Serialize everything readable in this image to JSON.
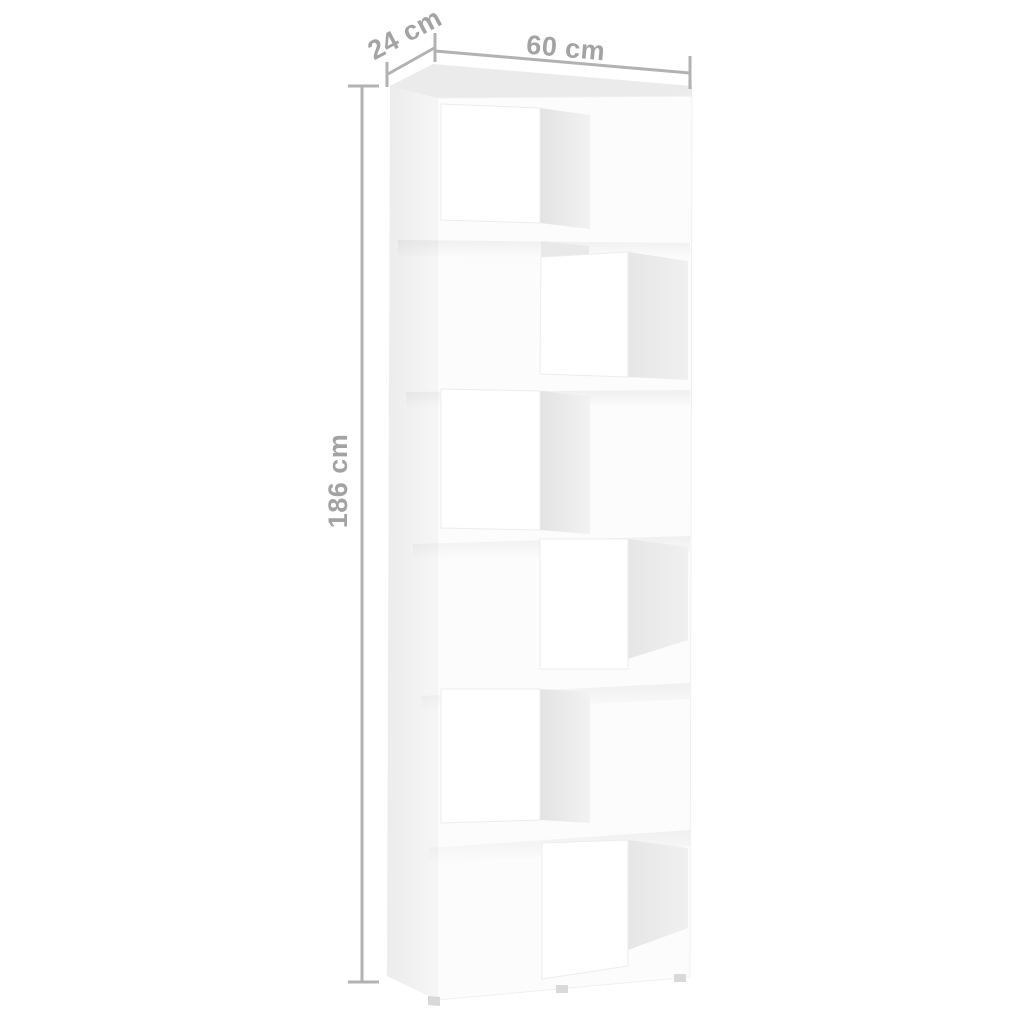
{
  "diagram": {
    "dimension_labels": {
      "depth": "24 cm",
      "width": "60 cm",
      "height": "186 cm"
    },
    "furniture": {
      "type_hint": "bookcase-room-divider",
      "compartment_count": 6,
      "opening_sides": [
        "left",
        "right",
        "left",
        "right",
        "left",
        "right"
      ],
      "feet_count": 3,
      "body_color": "#fcfcfc"
    },
    "style": {
      "background_color": "#ffffff",
      "dimension_line_color": "#b2b2b2",
      "dimension_text_color": "#a3a3a3",
      "top_face_color": "#ebebeb",
      "side_face_color": "#f1f1f1",
      "interior_shading_color": "#e5e5e5",
      "foot_color": "#d9d9d9"
    }
  }
}
